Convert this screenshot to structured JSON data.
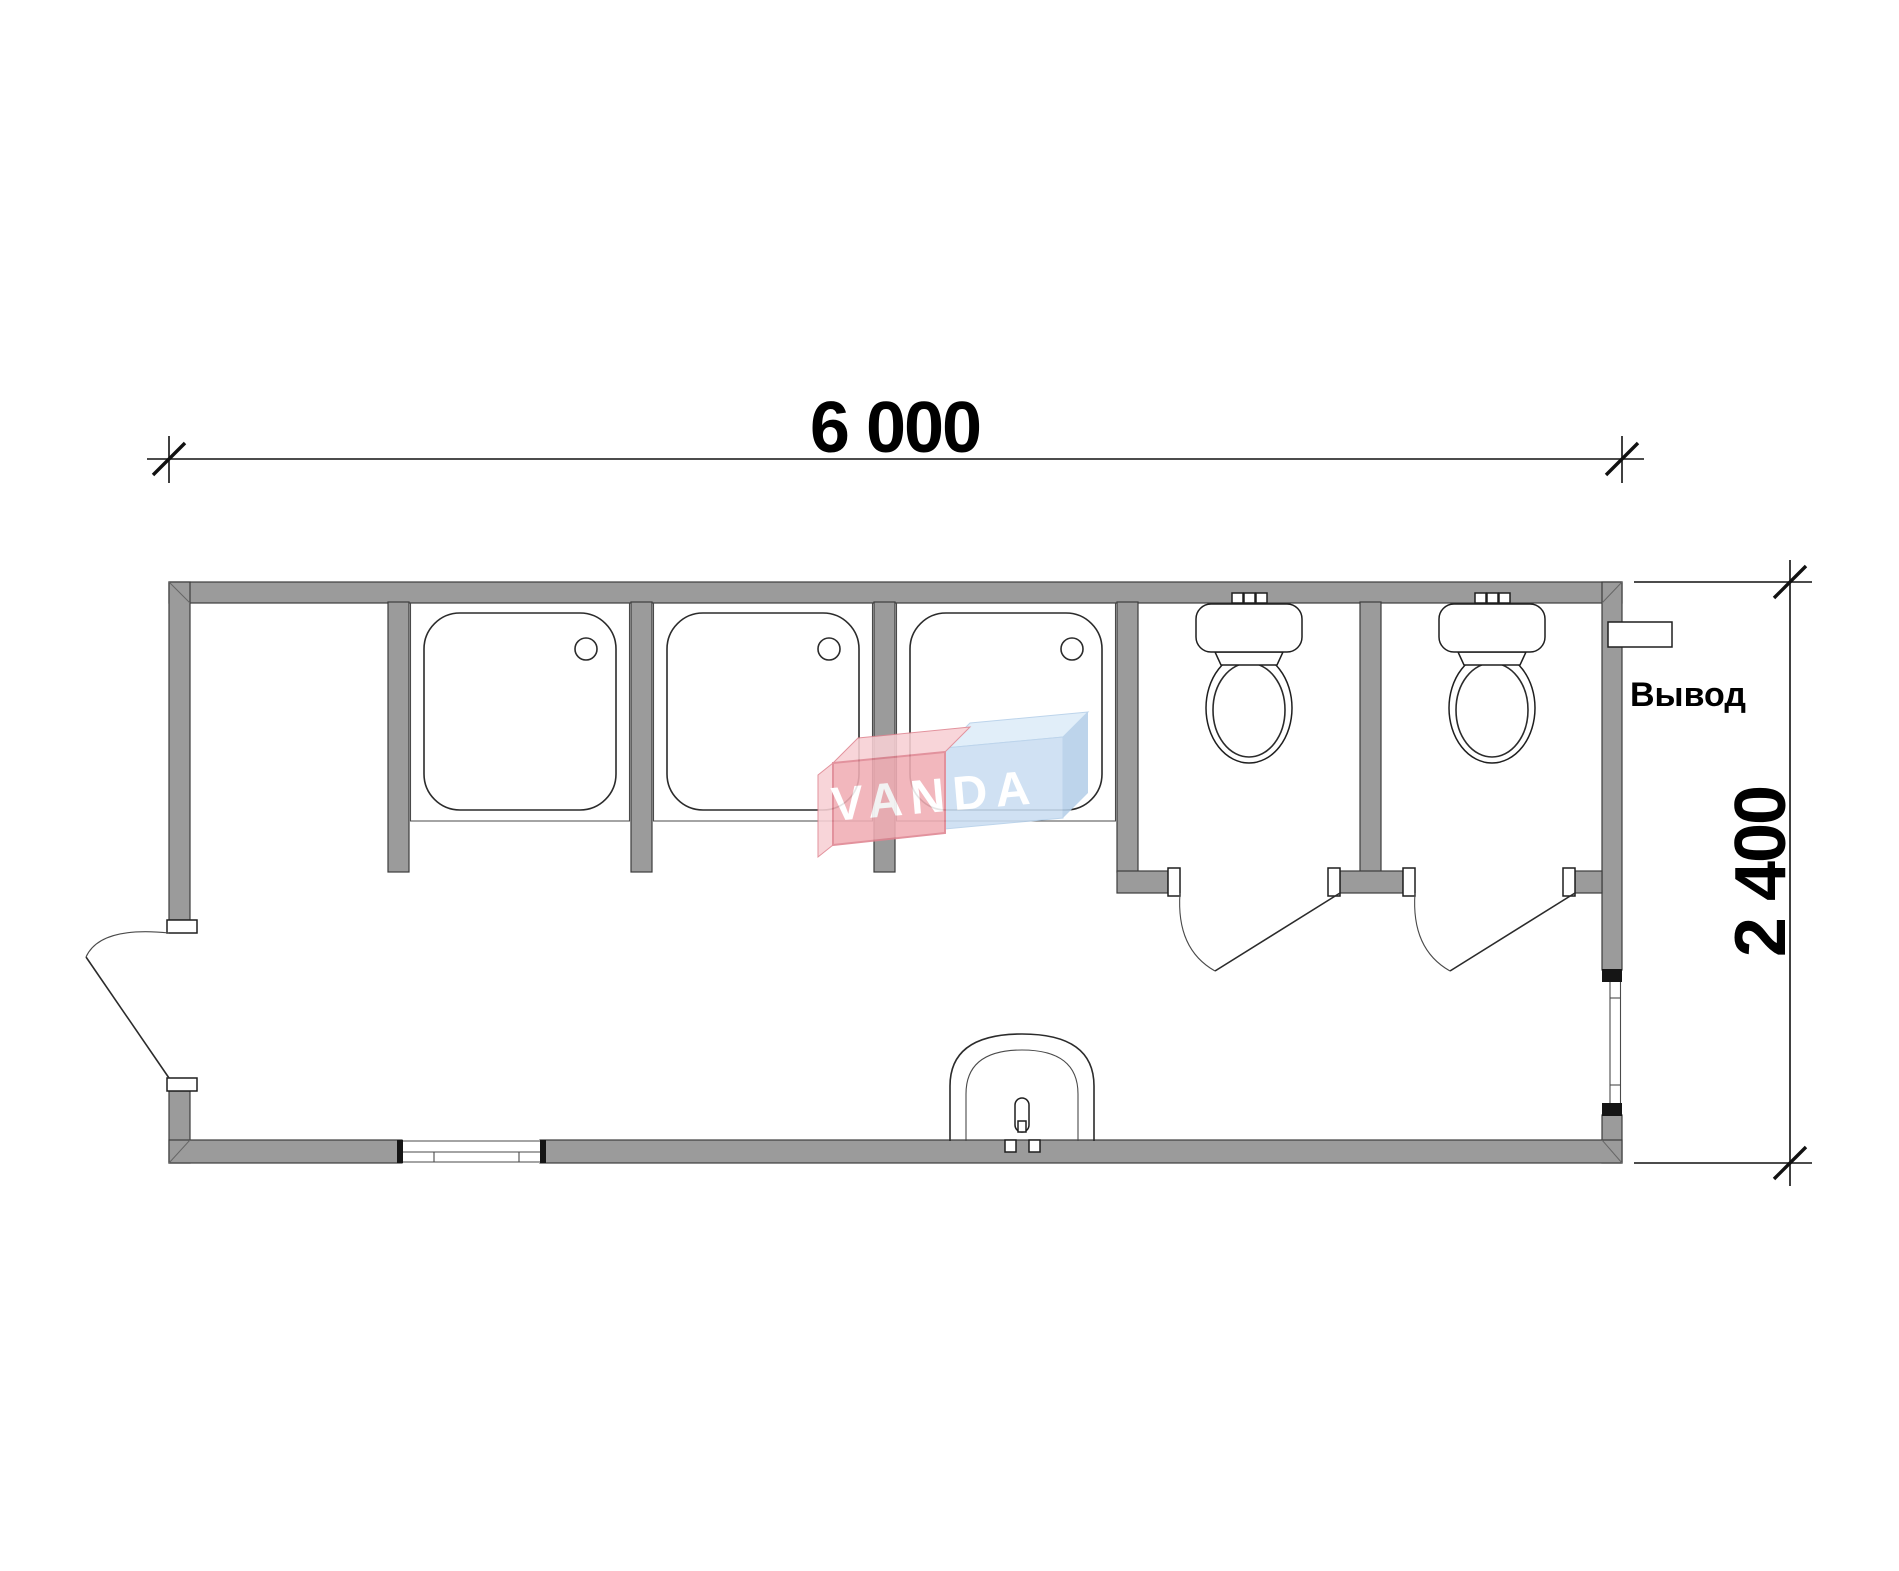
{
  "labels": {
    "width_dimension": "6 000",
    "height_dimension": "2 400",
    "outlet": "Вывод"
  },
  "watermark": {
    "text": "VANDA"
  },
  "plan": {
    "type": "floor-plan",
    "overall_width_mm": 6000,
    "overall_depth_mm": 2400,
    "rooms": [
      "entry-alcove",
      "shower-stall-1",
      "shower-stall-2",
      "shower-stall-3",
      "wc-stall-1",
      "wc-stall-2",
      "corridor"
    ],
    "fixtures": [
      "shower-tray-1",
      "shower-tray-2",
      "shower-tray-3",
      "toilet-1",
      "toilet-2",
      "washbasin"
    ],
    "openings": [
      "entrance-door-left-wall",
      "wc-door-1",
      "wc-door-2",
      "window-bottom-wall",
      "window-right-wall",
      "utility-outlet-right-wall"
    ]
  },
  "colors": {
    "paper": "#ffffff",
    "wall": "#9b9b9b",
    "line": "#2b2b2b",
    "logo_red": "#f1aeb5",
    "logo_red_top": "#f8d0d4",
    "logo_red_stroke": "#df8490",
    "logo_blue": "#cadef2",
    "logo_blue_top": "#ddecf9",
    "logo_blue_side": "#b4cfe9"
  }
}
